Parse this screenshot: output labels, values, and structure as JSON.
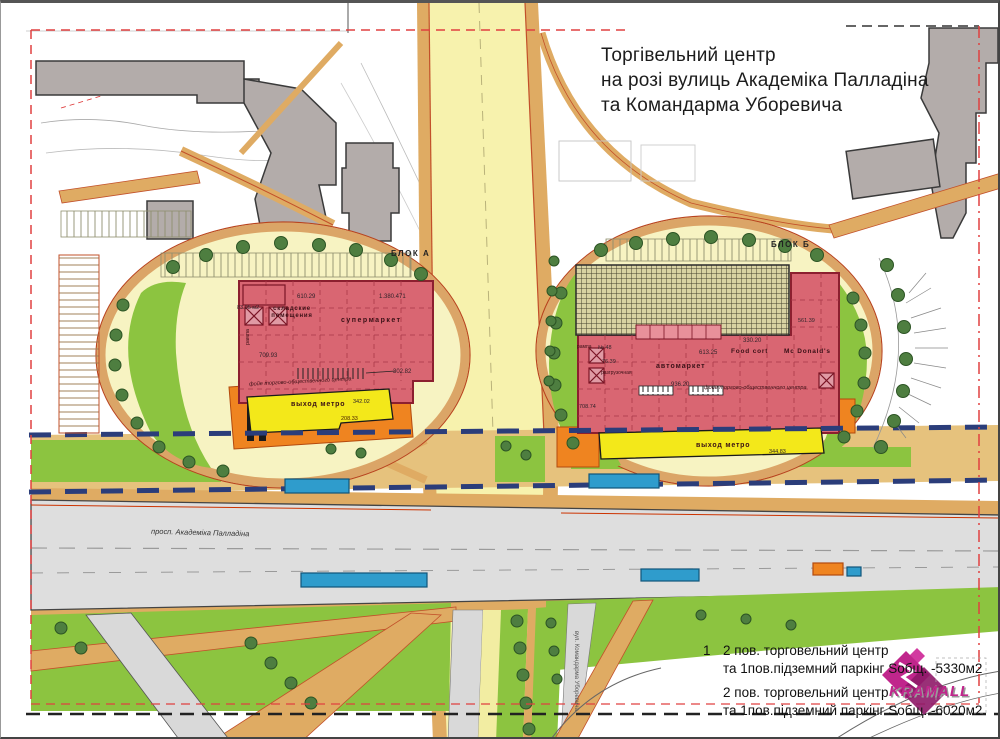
{
  "title": {
    "line1": "Торгівельний центр",
    "line2": "на розі вулиць Академіка Палладіна",
    "line3": "та Командарма Уборевича"
  },
  "blocks": {
    "block_a": "БЛОК А",
    "block_b": "БЛОК Б"
  },
  "streets": {
    "palladina": "просп. Академіка Палладіна",
    "uborevycha": "вул. Командарма Уборевича"
  },
  "left_building": {
    "area_top": "610.29",
    "area_top2": "1.380.471",
    "storage": "складские помещения",
    "small_area": "83.05 м2",
    "ramp": "рампа",
    "supermarket": "супермаркет",
    "area_mid": "709.93",
    "area_right": "302.82",
    "foyer": "фойе торгово-общественного центра",
    "metro_exit": "выход метро",
    "metro_area": "342.02",
    "orange_area": "208.33"
  },
  "right_building": {
    "ramp": "рампа",
    "n48": "№ 48",
    "a7639": "76.39",
    "unload": "разгрузочная",
    "automarket": "автомаркет",
    "a61325": "613.25",
    "a33020": "330.20",
    "foodcourt": "Food cort",
    "mcdonalds": "Mc Donald's",
    "a93620": "936.20",
    "foyer": "фойе торгово-общественного центра",
    "metro_exit": "выход метро",
    "a34483": "344.83",
    "a70874": "708.74",
    "a56139": "561.39"
  },
  "legend": {
    "item1_no": "1",
    "item1_line1": "2 пов. торговельний центр",
    "item1_line2": "та 1пов.підземний паркінг  Sобщ. -5330м2",
    "item2_line1": "2 пов. торговельний центр",
    "item2_line2": "та 1пов.підземний паркінг  Sобщ. -6020м2"
  },
  "logo": {
    "text": "KRAMALL"
  },
  "colors": {
    "building_pink": "#d96672",
    "building_outline": "#8c1f2f",
    "road_yellow": "#f7f2ad",
    "ring_tan": "#dba567",
    "orange": "#ef8420",
    "metro_yellow": "#f3e81a",
    "lawn_green": "#8cc440",
    "tree_green": "#4e7e40",
    "road_gray": "#dedede",
    "existing_gray": "#b3acaa",
    "metro_line_navy": "#2b3d7a",
    "boundary_red": "#e04040",
    "logo_magenta": "#c0268c",
    "stop_blue": "#2f9ccc"
  }
}
